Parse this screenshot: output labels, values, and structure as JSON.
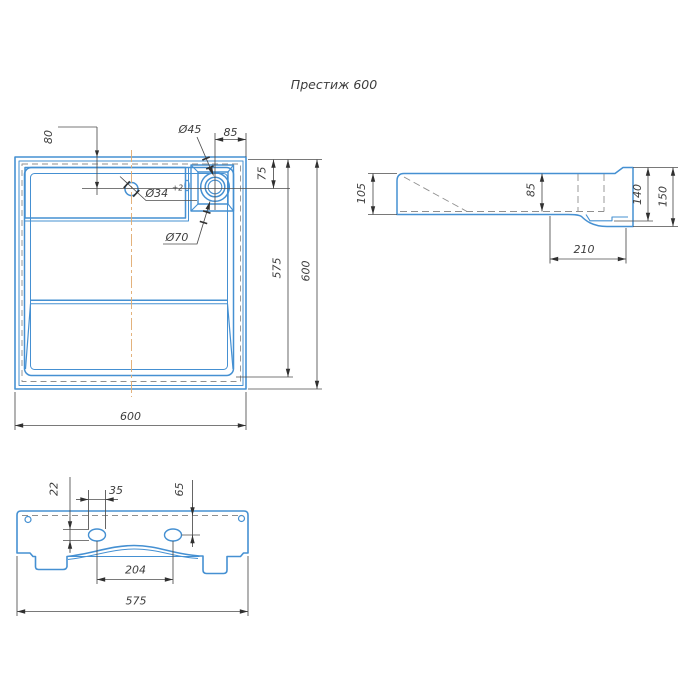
{
  "title": "Престиж 600",
  "colors": {
    "outline": "#4590d2",
    "dim_line": "#4d4d4d",
    "hidden_line": "#8f8f8f",
    "centerline": "#e0aa6e",
    "label_text": "#3d3d3d",
    "arrow": "#303030",
    "background": "#ffffff"
  },
  "top_view": {
    "dim_80": "80",
    "dia_45": "Ø45",
    "dim_85": "85",
    "dim_75": "75",
    "dia_34": "Ø34",
    "dia_34_tol": "+2",
    "dia_70": "Ø70",
    "dim_575": "575",
    "dim_600_right": "600",
    "dim_600_bottom": "600"
  },
  "side_view": {
    "dim_105": "105",
    "dim_85": "85",
    "dim_140": "140",
    "dim_150": "150",
    "dim_210": "210"
  },
  "front_view": {
    "dim_22": "22",
    "dim_35": "35",
    "dim_65": "65",
    "dim_204": "204",
    "dim_575": "575"
  }
}
